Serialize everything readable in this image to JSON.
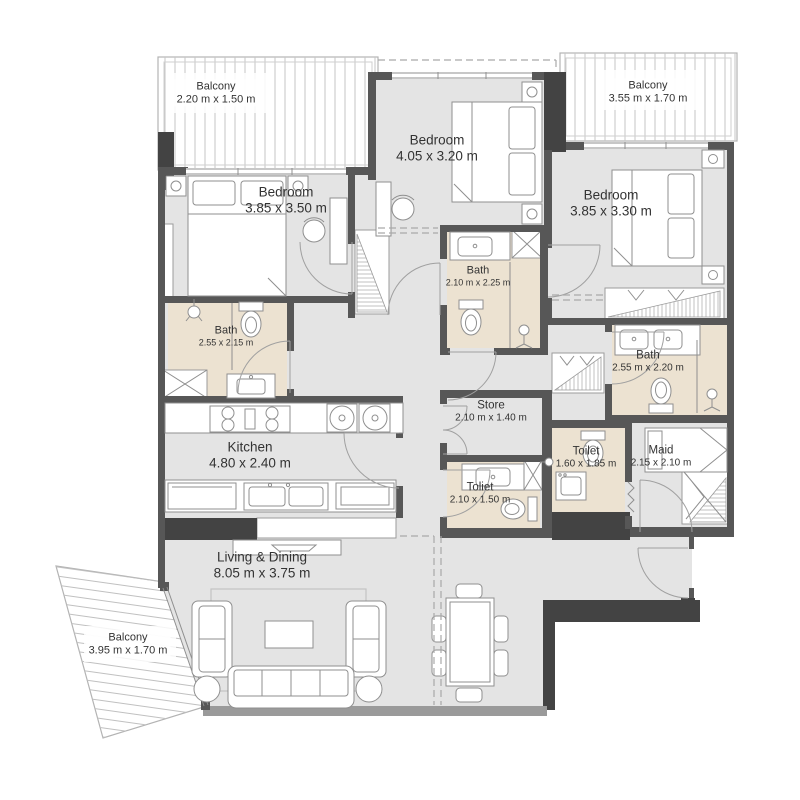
{
  "colors": {
    "wall": "#575757",
    "wall_dark": "#434343",
    "floor": "#e4e4e4",
    "bath_floor": "#ece2d1",
    "window_wall": "#9a9a9a",
    "line": "#8f8f8f",
    "text": "#333333"
  },
  "rooms": [
    {
      "id": "balcony-top-left",
      "name": "Balcony",
      "dims": "2.20 m x 1.50 m"
    },
    {
      "id": "bedroom-top",
      "name": "Bedroom",
      "dims": "4.05 x 3.20 m"
    },
    {
      "id": "balcony-top-right",
      "name": "Balcony",
      "dims": "3.55 m x 1.70 m"
    },
    {
      "id": "bedroom-left",
      "name": "Bedroom",
      "dims": "3.85 x 3.50 m"
    },
    {
      "id": "bedroom-right",
      "name": "Bedroom",
      "dims": "3.85 x 3.30 m"
    },
    {
      "id": "bath-middle",
      "name": "Bath",
      "dims": "2.10 m x 2.25 m"
    },
    {
      "id": "bath-left",
      "name": "Bath",
      "dims": "2.55 x 2.15 m"
    },
    {
      "id": "bath-right",
      "name": "Bath",
      "dims": "2.55 m x 2.20 m"
    },
    {
      "id": "kitchen",
      "name": "Kitchen",
      "dims": "4.80 x 2.40 m"
    },
    {
      "id": "store",
      "name": "Store",
      "dims": "2.10 m x 1.40 m"
    },
    {
      "id": "toilet-left",
      "name": "Toliet",
      "dims": "2.10 x 1.50 m"
    },
    {
      "id": "toilet-right",
      "name": "Toilet",
      "dims": "1.60 x 1.85 m"
    },
    {
      "id": "maid",
      "name": "Maid",
      "dims": "2.15 x 2.10 m"
    },
    {
      "id": "living-dining",
      "name": "Living & Dining",
      "dims": "8.05 m x 3.75 m"
    },
    {
      "id": "balcony-bottom",
      "name": "Balcony",
      "dims": "3.95 m x 1.70 m"
    }
  ]
}
